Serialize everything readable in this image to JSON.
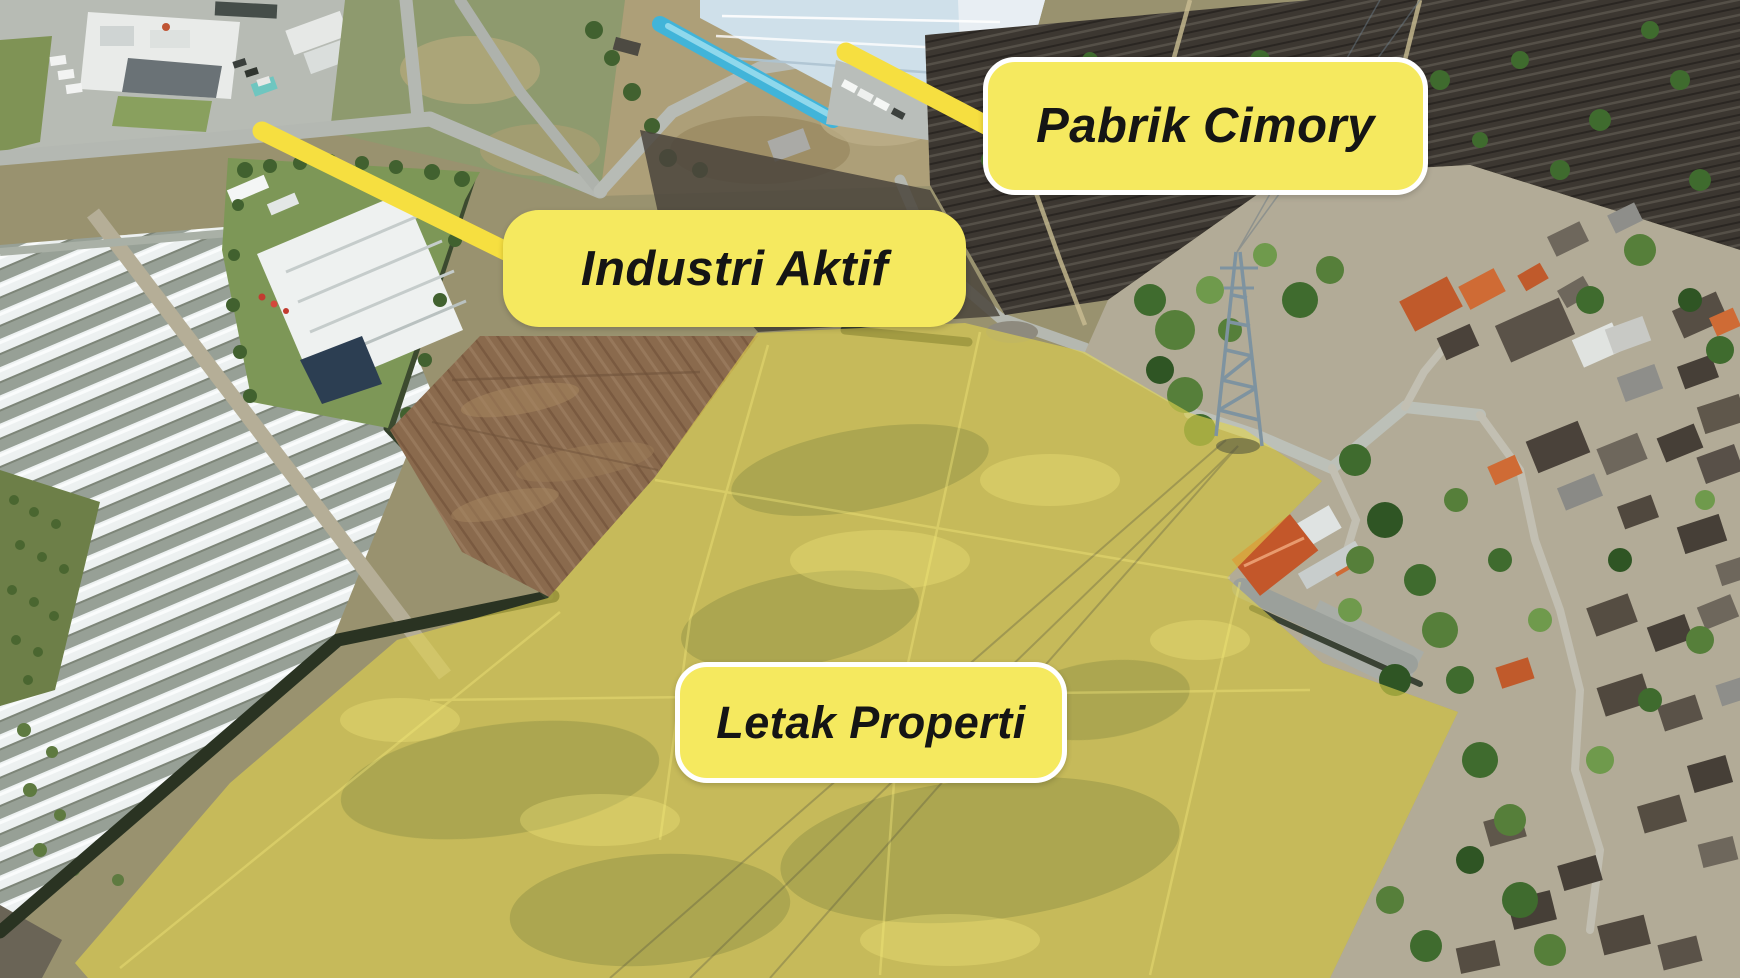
{
  "scene": {
    "type": "aerial-drone-photo",
    "subject": "industrial-area-property-location"
  },
  "callouts": {
    "pabrik_cimory": {
      "label": "Pabrik Cimory"
    },
    "industri_aktif": {
      "label": "Industri Aktif"
    },
    "letak_properti": {
      "label": "Letak Properti"
    }
  },
  "colors": {
    "callout_background": "#F5E95F",
    "callout_text": "#151515",
    "callout_border": "#FFFFFF",
    "leader_line": "#F6DF40",
    "property_overlay_fill": "#E2D34D",
    "property_overlay_opacity": "0.62"
  }
}
